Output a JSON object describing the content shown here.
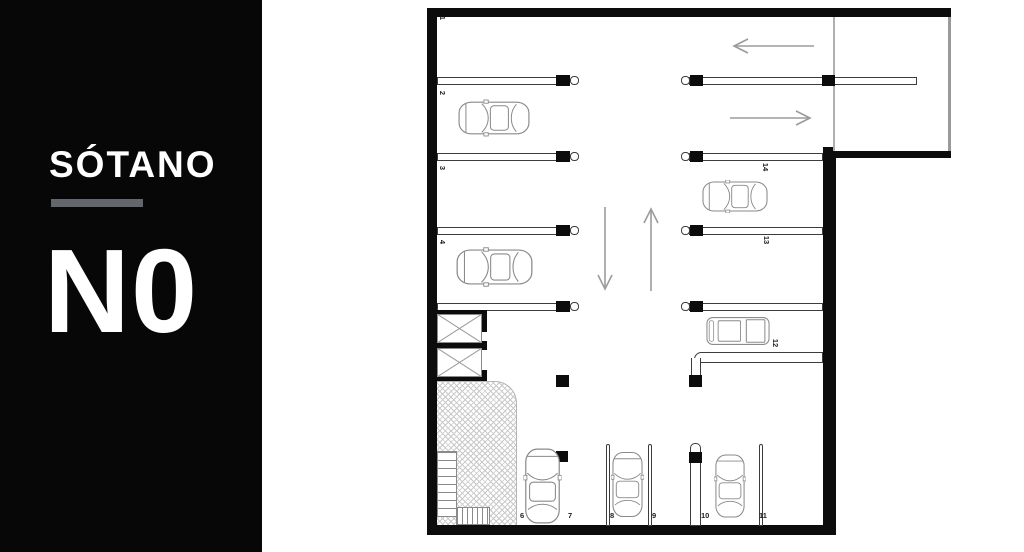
{
  "panel": {
    "title": "SÓTANO",
    "level": "N0"
  },
  "plan": {
    "spots": {
      "s1": "1",
      "s2": "2",
      "s3": "3",
      "s4": "4",
      "s6": "6",
      "s7": "7",
      "s8": "8",
      "s9": "9",
      "s10": "10",
      "s11": "11",
      "s12": "12",
      "s13": "13",
      "s14": "14"
    },
    "icons": {
      "cars": [
        "sedan-top-icon",
        "truck-top-icon"
      ],
      "arrows": [
        "arrow-left-icon",
        "arrow-right-icon",
        "arrow-up-icon",
        "arrow-down-icon"
      ],
      "elevator": "elevator-shaft-icon",
      "stairs": "stairs-icon"
    },
    "colors": {
      "wall": "#0c0c0c",
      "panel_background": "#070707",
      "panel_divider": "#63676d",
      "arrow": "#9b9b9b",
      "car_outline": "#8a8a8a",
      "line": "#3c3c3c"
    }
  }
}
